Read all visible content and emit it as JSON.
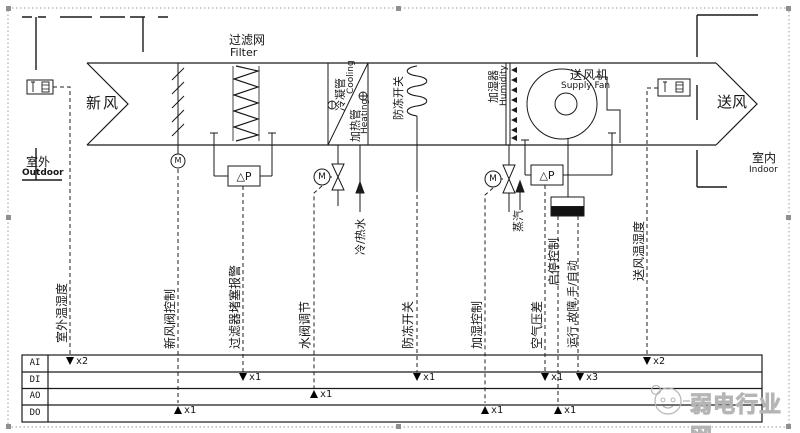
{
  "unit": {
    "fresh_air": "新风",
    "supply_air": "送风",
    "outdoor_zh": "室外",
    "outdoor_en": "Outdoor",
    "indoor_zh": "室内",
    "indoor_en": "Indoor",
    "filter_zh": "过滤网",
    "filter_en": "Filter",
    "cooling_zh": "冷凝管",
    "cooling_en": "Cooling",
    "heating_zh": "加热管",
    "heating_en": "Heating",
    "freeze_zh": "防冻开关",
    "humidifier_zh": "加湿器",
    "humidifier_en": "Humidity",
    "fan_zh": "送风机",
    "fan_en": "Supply Fan",
    "chw_pipe": "冷/热水",
    "steam_pipe": "蒸汽",
    "dp_label": "△P",
    "motor_label": "M"
  },
  "signals": {
    "outdoor_th": "室外温湿度",
    "fresh_air_damper": "新风阀控制",
    "filter_alarm": "过滤器堵塞报警",
    "water_valve": "水阀调节",
    "freeze_switch": "防冻开关",
    "humidify_ctrl": "加湿控制",
    "air_dp": "空气压差",
    "start_stop": "启停控制",
    "run_fault_auto": "运行,故障,手/自动",
    "supply_th": "送风温湿度"
  },
  "io_table": {
    "rows": [
      "AI",
      "DI",
      "AO",
      "DO"
    ],
    "points": {
      "ai_outdoor": "x2",
      "ai_supply": "x2",
      "di_filter": "x1",
      "di_freeze": "x1",
      "di_airdp": "x1",
      "di_run": "x3",
      "ao_watervalve": "x1",
      "do_damper": "x1",
      "do_humidify": "x1",
      "do_startstop": "x1"
    }
  },
  "watermark": {
    "text": "弱电行业网"
  },
  "colors": {
    "line": "#1a1a1a",
    "watermark": "#b5b5b5",
    "handle": "#8f8f8f"
  }
}
